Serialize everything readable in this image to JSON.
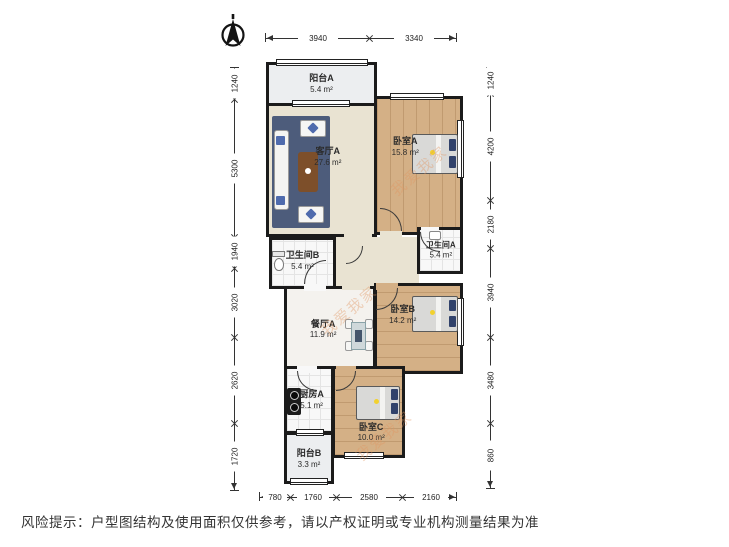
{
  "footer": {
    "text": "风险提示：户型图结构及使用面积仅供参考，请以产权证明或专业机构测量结果为准"
  },
  "watermark": {
    "text": "我爱我家"
  },
  "rooms": {
    "balcony_a": {
      "name": "阳台A",
      "area": "5.4 m²"
    },
    "living_a": {
      "name": "客厅A",
      "area": "27.6 m²"
    },
    "bedroom_a": {
      "name": "卧室A",
      "area": "15.8 m²"
    },
    "bath_b": {
      "name": "卫生间B",
      "area": "5.4 m²"
    },
    "bath_a": {
      "name": "卫生间A",
      "area": "5.4 m²"
    },
    "dining_a": {
      "name": "餐厅A",
      "area": "11.9 m²"
    },
    "bedroom_b": {
      "name": "卧室B",
      "area": "14.2 m²"
    },
    "kitchen_a": {
      "name": "厨房A",
      "area": "5.1 m²"
    },
    "bedroom_c": {
      "name": "卧室C",
      "area": "10.0 m²"
    },
    "balcony_b": {
      "name": "阳台B",
      "area": "3.3 m²"
    }
  },
  "dimensions": {
    "top": [
      "3940",
      "3340"
    ],
    "bottom": [
      "780",
      "1760",
      "2580",
      "2160"
    ],
    "left": [
      "1240",
      "5300",
      "1940",
      "3020",
      "2620",
      "1720"
    ],
    "right": [
      "1240",
      "4200",
      "2180",
      "3940",
      "3480",
      "860"
    ]
  },
  "colors": {
    "wall": "#1b1b1b",
    "wood_floor": "#d4b086",
    "living_floor": "#e9e3d2",
    "tile_floor": "#f8f8f8",
    "rug": "#4d5c7b",
    "watermark": "#e09661"
  }
}
